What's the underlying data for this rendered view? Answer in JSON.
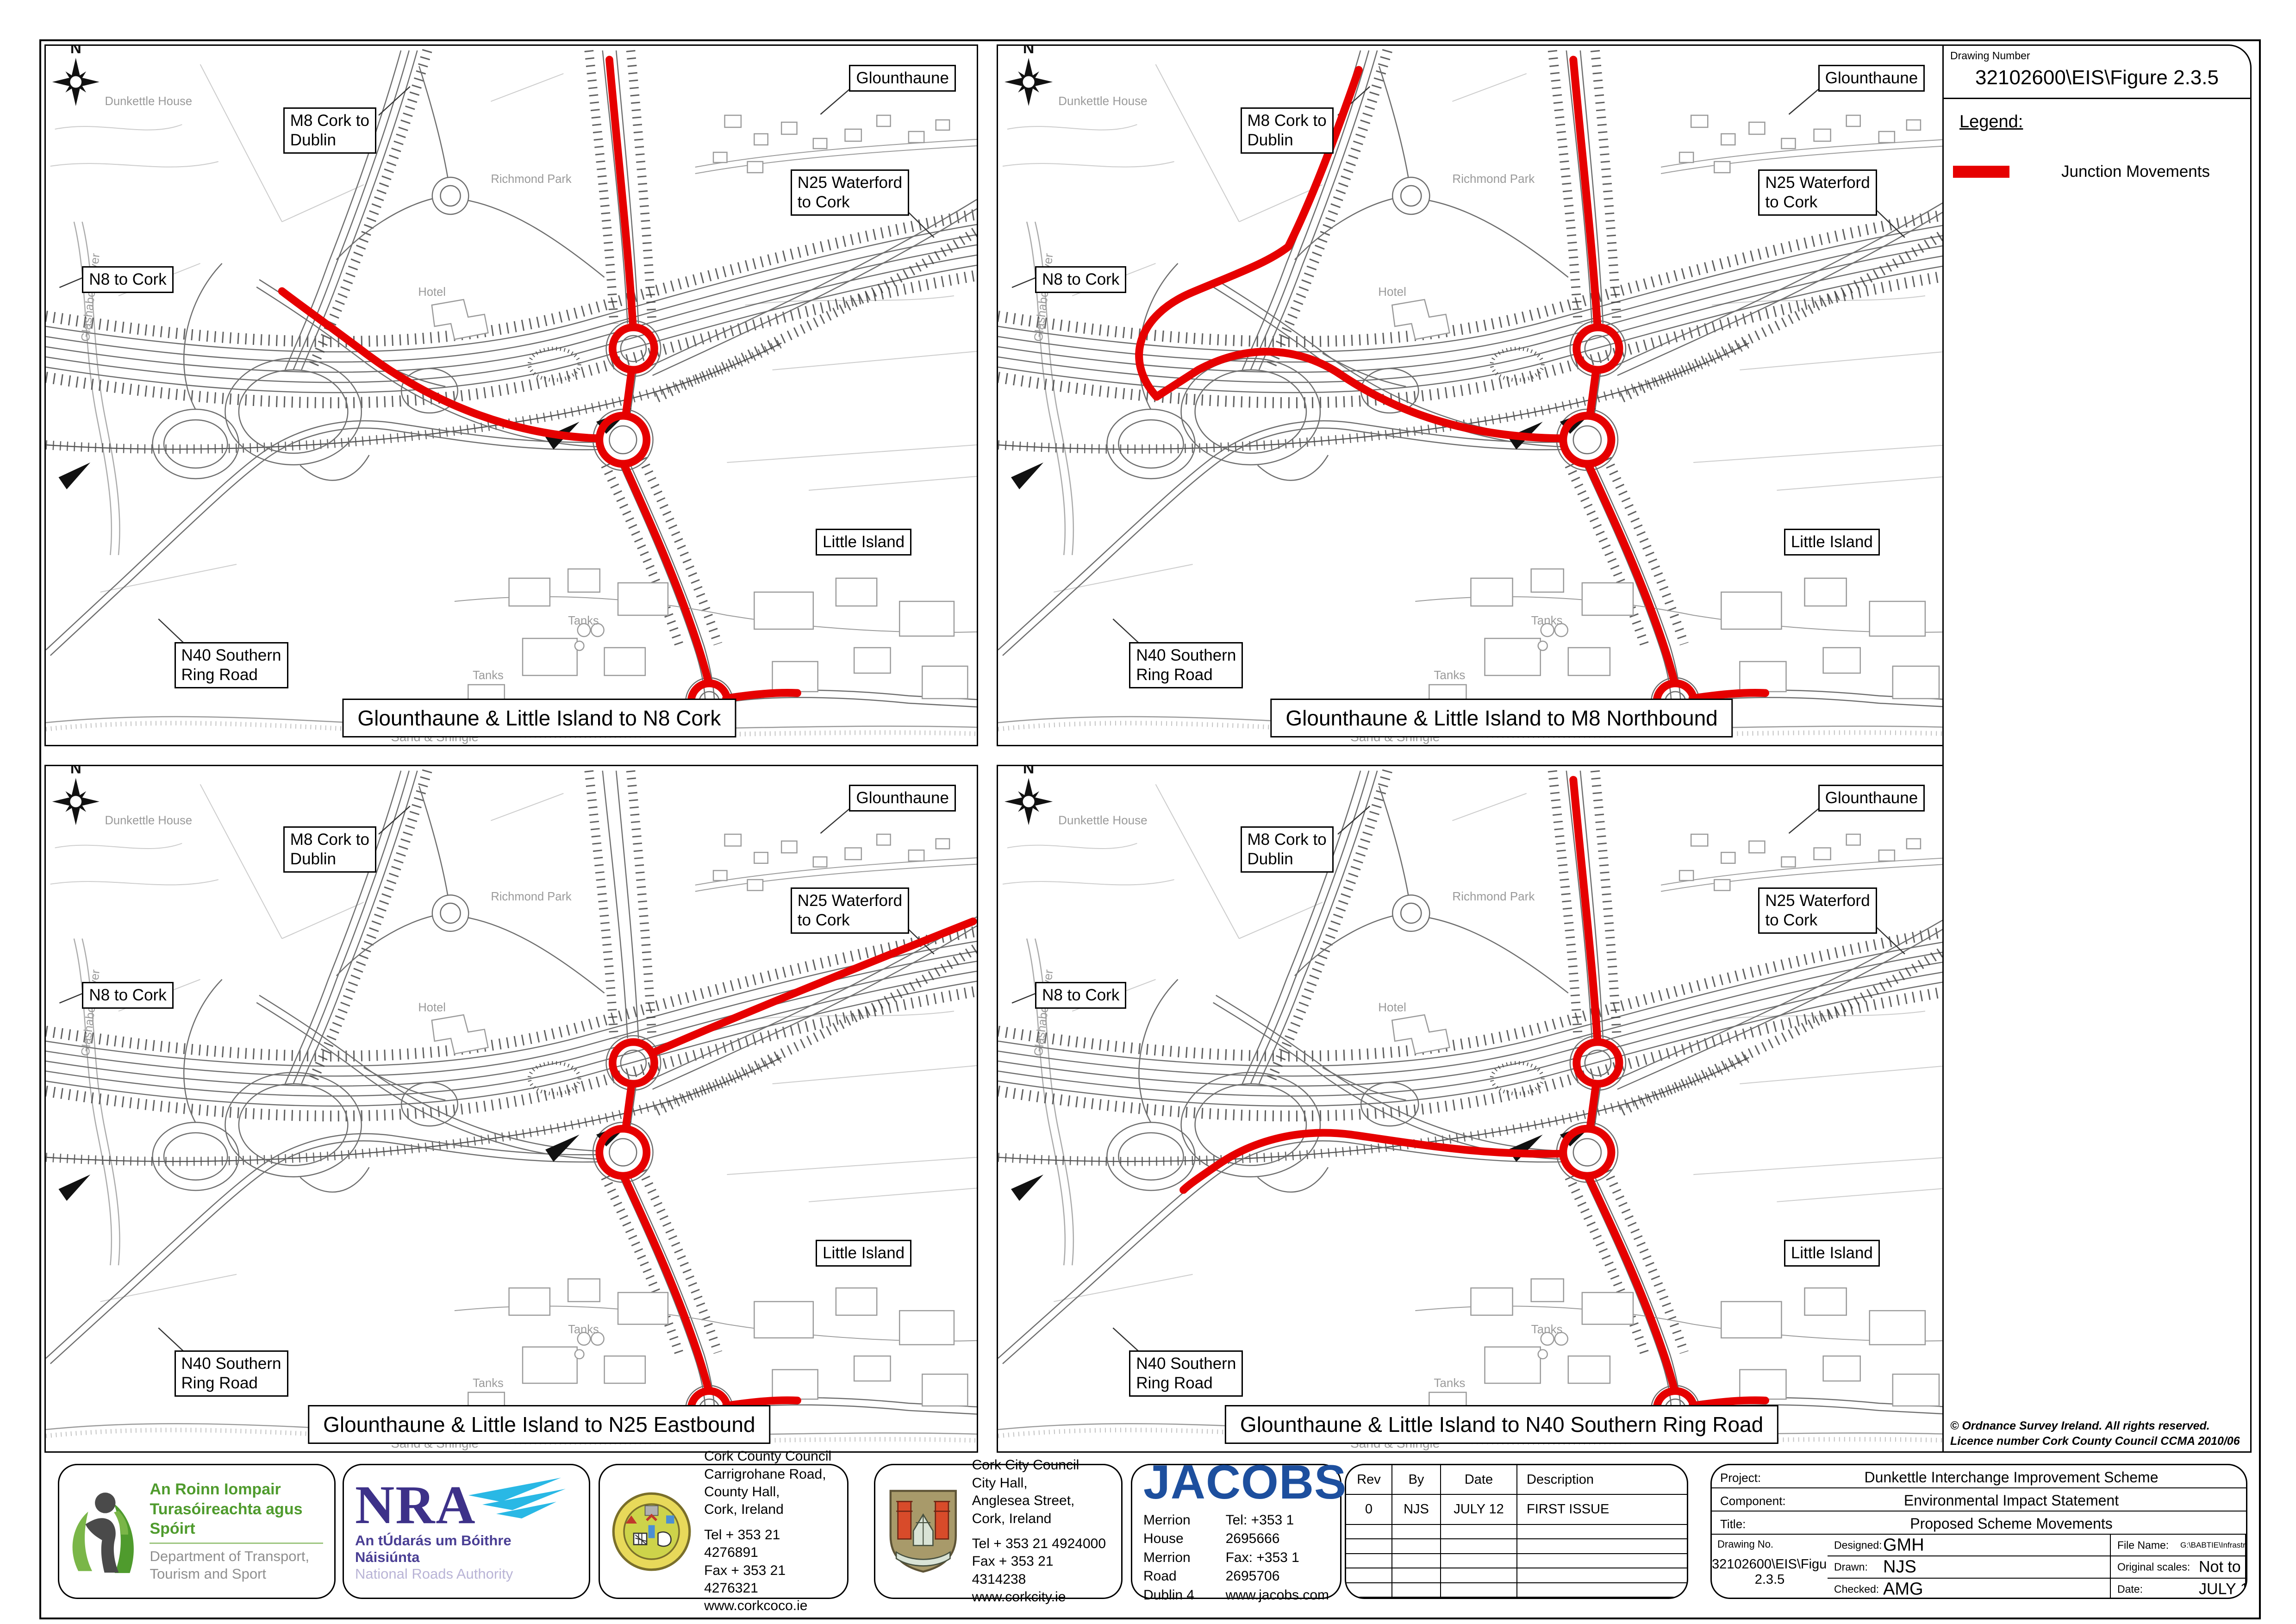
{
  "colors": {
    "junction_movement": "#e60000",
    "dept_green": "#4f9b2d",
    "nra_indigo": "#3d3189",
    "nra_cyan": "#29b8e5",
    "jacobs_blue": "#1d4f9e"
  },
  "drawing": {
    "number_label": "Drawing Number",
    "number": "32102600\\EIS\\Figure 2.3.5",
    "legend_label": "Legend:",
    "legend_item": "Junction Movements",
    "copyright": "© Ordnance Survey Ireland. All rights reserved. Licence number Cork County Council CCMA 2010/06"
  },
  "callouts": {
    "glounthaune": "Glounthaune",
    "m8_line1": "M8 Cork to",
    "m8_line2": "Dublin",
    "n25_line1": "N25 Waterford",
    "n25_line2": "to Cork",
    "n8": "N8 to Cork",
    "little_island": "Little Island",
    "n40_line1": "N40 Southern",
    "n40_line2": "Ring Road"
  },
  "map_texts": {
    "north": "N",
    "dunkettle_house": "Dunkettle House",
    "richmond_park": "Richmond Park",
    "hotel": "Hotel",
    "tanks_a": "Tanks",
    "tanks_b": "Tanks",
    "sand_shingle": "Sand & Shingle",
    "river": "Glashaboy River"
  },
  "panels": [
    {
      "title": "Glounthaune & Little Island to N8 Cork",
      "red_path": "M1241,30 C1258,220 1283,440 1293,606 M1290,701 L1277,798 M1218,848 C1040,842 862,780 704,664 C618,600 562,562 520,530 M1273,904 C1319,1004 1389,1152 1438,1302 C1448,1333 1456,1360 1459,1376 M1498,1410 C1560,1400 1610,1396 1655,1398 M1340,654 A46,46 0 1 1 1248,654 A46,46 0 1 1 1340,654 M1323,851 A52,52 0 1 1 1219,851 A52,52 0 1 1 1323,851 M1501,1417 A40,40 0 1 1 1421,1417 A40,40 0 1 1 1501,1417"
    },
    {
      "title": "Glounthaune & Little Island to M8 Northbound",
      "red_path": "M1241,30 C1258,220 1283,440 1293,606 M1290,701 L1277,798 M1218,848 C1040,846 882,806 742,712 C652,650 540,642 432,700 L342,758 M342,758 C272,680 300,582 420,532 C520,490 582,468 626,434 C678,330 730,190 778,52 M1273,904 C1319,1004 1389,1152 1438,1302 C1448,1333 1456,1360 1459,1376 M1498,1410 C1560,1400 1610,1396 1655,1398 M1340,654 A46,46 0 1 1 1248,654 A46,46 0 1 1 1340,654 M1323,851 A52,52 0 1 1 1219,851 A52,52 0 1 1 1323,851 M1501,1417 A40,40 0 1 1 1421,1417 A40,40 0 1 1 1501,1417"
    },
    {
      "title": "Glounthaune & Little Island to N25 Eastbound",
      "red_path": "M1336,632 C1500,560 1760,454 2042,342 M1290,701 L1277,798 M1273,904 C1319,1004 1389,1152 1438,1302 C1448,1333 1456,1360 1459,1376 M1498,1410 C1560,1400 1610,1396 1655,1398 M1340,654 A46,46 0 1 1 1248,654 A46,46 0 1 1 1340,654 M1323,851 A52,52 0 1 1 1219,851 A52,52 0 1 1 1323,851 M1501,1417 A40,40 0 1 1 1421,1417 A40,40 0 1 1 1501,1417"
    },
    {
      "title": "Glounthaune & Little Island to N40 Southern Ring Road",
      "red_path": "M1241,30 C1258,220 1283,440 1293,606 M1290,701 L1277,798 M1218,854 C1040,858 900,832 762,812 C642,796 542,830 472,880 C432,908 412,922 400,934 M1273,904 C1319,1004 1389,1152 1438,1302 C1448,1333 1456,1360 1459,1376 M1498,1410 C1560,1400 1610,1396 1655,1398 M1340,654 A46,46 0 1 1 1248,654 A46,46 0 1 1 1340,654 M1323,851 A52,52 0 1 1 1219,851 A52,52 0 1 1 1323,851 M1501,1417 A40,40 0 1 1 1421,1417 A40,40 0 1 1 1501,1417"
    }
  ],
  "logos": {
    "dept": {
      "irish_line1": "An Roinn Iompair",
      "irish_line2": "Turasóireachta agus Spóirt",
      "english_line1": "Department of Transport,",
      "english_line2": "Tourism and Sport"
    },
    "nra": {
      "name": "NRA",
      "irish": "An tÚdarás um Bóithre Náisiúnta",
      "english": "National Roads Authority"
    },
    "coco": {
      "name": "Cork County Council",
      "addr1": "Carrigrohane Road,",
      "addr2": "County Hall,",
      "addr3": "Cork, Ireland",
      "tel": "Tel  + 353 21 4276891",
      "fax": "Fax + 353 21 4276321",
      "web": "www.corkcoco.ie"
    },
    "city": {
      "name": "Cork City Council",
      "addr1": "City Hall,",
      "addr2": "Anglesea Street,",
      "addr3": "Cork, Ireland",
      "tel": "Tel  + 353 21 4924000",
      "fax": "Fax + 353 21 4314238",
      "web": "www.corkcity.ie"
    },
    "jacobs": {
      "name": "JACOBS",
      "addr1": "Merrion House",
      "addr2": "Merrion Road",
      "addr3": "Dublin 4",
      "tel": "Tel: +353 1 2695666",
      "fax": "Fax: +353 1 2695706",
      "web": "www.jacobs.com"
    }
  },
  "rev_table": {
    "headers": [
      "Rev",
      "By",
      "Date",
      "Description"
    ],
    "rows": [
      [
        "0",
        "NJS",
        "JULY 12",
        "FIRST ISSUE"
      ]
    ]
  },
  "title_block": {
    "project_label": "Project:",
    "project": "Dunkettle Interchange Improvement Scheme",
    "component_label": "Component:",
    "component": "Environmental Impact Statement",
    "title_label": "Title:",
    "title": "Proposed Scheme Movements",
    "designed_label": "Designed:",
    "designed": "GMH",
    "file_label": "File Name:",
    "file_name": "G:\\BABTIE\\Infrastructure\\highways\\32102600 Dunkettle Interchange Cork\\File 14 - CAD MX",
    "drawn_label": "Drawn:",
    "drawn": "NJS",
    "scale_label": "Original scales:",
    "scale": "Not to Scale",
    "checked_label": "Checked:",
    "checked": "AMG",
    "date_label": "Date:",
    "date": "JULY 12",
    "drawing_no_label": "Drawing No.",
    "drawing_no": "32102600\\EIS\\Figure 2.3.5"
  }
}
